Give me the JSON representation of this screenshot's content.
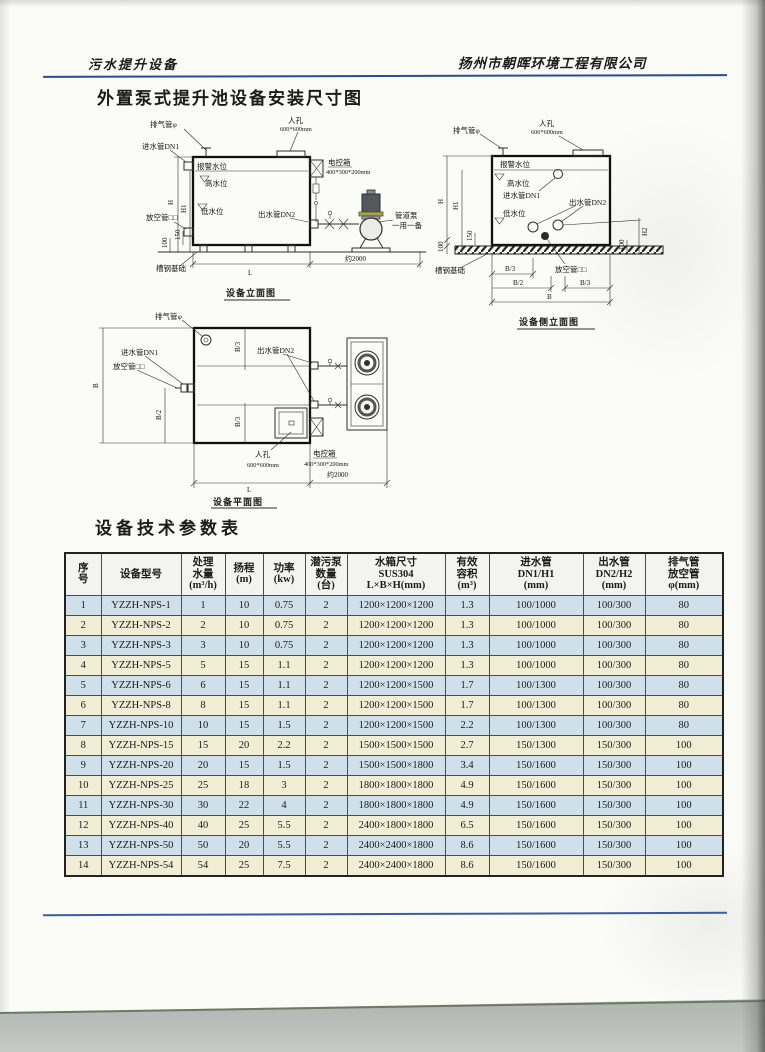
{
  "page": {
    "header_left": "污水提升设备",
    "header_right": "扬州市朝晖环境工程有限公司",
    "title": "外置泵式提升池设备安装尺寸图"
  },
  "colors": {
    "rule_blue": "#2a4b9b",
    "row_blue": "#cfe0ea",
    "row_cream": "#f2edd5",
    "paper": "#fbfbf8"
  },
  "drawings": {
    "elevation": {
      "caption": "设备立面图",
      "labels": {
        "vent": "排气管φ",
        "inlet": "进水管DN1",
        "manhole": "人孔",
        "manhole_size": "600*600mm",
        "control_box": "电控箱",
        "control_box_size": "400*300*200mm",
        "alarm_level": "报警水位",
        "high_level": "高水位",
        "low_level": "低水位",
        "drain": "放空管□□",
        "outlet": "出水管DN2",
        "pump": "管道泵",
        "pump_note": "一用一备",
        "base": "槽钢基础"
      },
      "dims": {
        "h": "H",
        "h1": "H1",
        "d100": "100",
        "d150": "150",
        "l": "L",
        "pump_span": "约2000"
      }
    },
    "side": {
      "caption": "设备侧立面图",
      "labels": {
        "vent": "排气管φ",
        "manhole": "人孔",
        "manhole_size": "600*600mm",
        "alarm_level": "报警水位",
        "high_level": "高水位",
        "inlet": "进水管DN1",
        "outlet": "出水管DN2",
        "low_level": "低水位",
        "base": "槽钢基础",
        "drain": "放空管□□"
      },
      "dims": {
        "h": "H",
        "h1": "H1",
        "d100": "100",
        "d150": "150",
        "h2": "H2",
        "d100r": "100",
        "b3a": "B/3",
        "b2": "B/2",
        "b3b": "B/3",
        "b": "B"
      }
    },
    "plan": {
      "caption": "设备平面图",
      "labels": {
        "vent": "排气管φ",
        "inlet": "进水管DN1",
        "drain": "放空管□□",
        "outlet": "出水管DN2",
        "manhole": "人孔",
        "manhole_size": "600*600mm",
        "control_box": "电控箱",
        "control_box_size": "400*300*200mm"
      },
      "dims": {
        "b": "B",
        "b2": "B/2",
        "b3a": "B/3",
        "b3b": "B/3",
        "l": "L",
        "pump_span": "约2000"
      }
    }
  },
  "table": {
    "title": "设备技术参数表",
    "headers": [
      [
        "序",
        "号"
      ],
      [
        "设备型号"
      ],
      [
        "处理",
        "水量",
        "(m³/h)"
      ],
      [
        "扬程",
        "(m)"
      ],
      [
        "功率",
        "(kw)"
      ],
      [
        "潜污泵",
        "数量",
        "(台)"
      ],
      [
        "水箱尺寸",
        "SUS304",
        "L×B×H(mm)"
      ],
      [
        "有效",
        "容积",
        "(m³)"
      ],
      [
        "进水管",
        "DN1/H1",
        "(mm)"
      ],
      [
        "出水管",
        "DN2/H2",
        "(mm)"
      ],
      [
        "排气管",
        "放空管",
        "φ(mm)"
      ]
    ],
    "rows": [
      [
        "1",
        "YZZH-NPS-1",
        "1",
        "10",
        "0.75",
        "2",
        "1200×1200×1200",
        "1.3",
        "100/1000",
        "100/300",
        "80"
      ],
      [
        "2",
        "YZZH-NPS-2",
        "2",
        "10",
        "0.75",
        "2",
        "1200×1200×1200",
        "1.3",
        "100/1000",
        "100/300",
        "80"
      ],
      [
        "3",
        "YZZH-NPS-3",
        "3",
        "10",
        "0.75",
        "2",
        "1200×1200×1200",
        "1.3",
        "100/1000",
        "100/300",
        "80"
      ],
      [
        "4",
        "YZZH-NPS-5",
        "5",
        "15",
        "1.1",
        "2",
        "1200×1200×1200",
        "1.3",
        "100/1000",
        "100/300",
        "80"
      ],
      [
        "5",
        "YZZH-NPS-6",
        "6",
        "15",
        "1.1",
        "2",
        "1200×1200×1500",
        "1.7",
        "100/1300",
        "100/300",
        "80"
      ],
      [
        "6",
        "YZZH-NPS-8",
        "8",
        "15",
        "1.1",
        "2",
        "1200×1200×1500",
        "1.7",
        "100/1300",
        "100/300",
        "80"
      ],
      [
        "7",
        "YZZH-NPS-10",
        "10",
        "15",
        "1.5",
        "2",
        "1200×1200×1500",
        "2.2",
        "100/1300",
        "100/300",
        "80"
      ],
      [
        "8",
        "YZZH-NPS-15",
        "15",
        "20",
        "2.2",
        "2",
        "1500×1500×1500",
        "2.7",
        "150/1300",
        "150/300",
        "100"
      ],
      [
        "9",
        "YZZH-NPS-20",
        "20",
        "15",
        "1.5",
        "2",
        "1500×1500×1800",
        "3.4",
        "150/1600",
        "150/300",
        "100"
      ],
      [
        "10",
        "YZZH-NPS-25",
        "25",
        "18",
        "3",
        "2",
        "1800×1800×1800",
        "4.9",
        "150/1600",
        "150/300",
        "100"
      ],
      [
        "11",
        "YZZH-NPS-30",
        "30",
        "22",
        "4",
        "2",
        "1800×1800×1800",
        "4.9",
        "150/1600",
        "150/300",
        "100"
      ],
      [
        "12",
        "YZZH-NPS-40",
        "40",
        "25",
        "5.5",
        "2",
        "2400×1800×1800",
        "6.5",
        "150/1600",
        "150/300",
        "100"
      ],
      [
        "13",
        "YZZH-NPS-50",
        "50",
        "20",
        "5.5",
        "2",
        "2400×2400×1800",
        "8.6",
        "150/1600",
        "150/300",
        "100"
      ],
      [
        "14",
        "YZZH-NPS-54",
        "54",
        "25",
        "7.5",
        "2",
        "2400×2400×1800",
        "8.6",
        "150/1600",
        "150/300",
        "100"
      ]
    ]
  }
}
